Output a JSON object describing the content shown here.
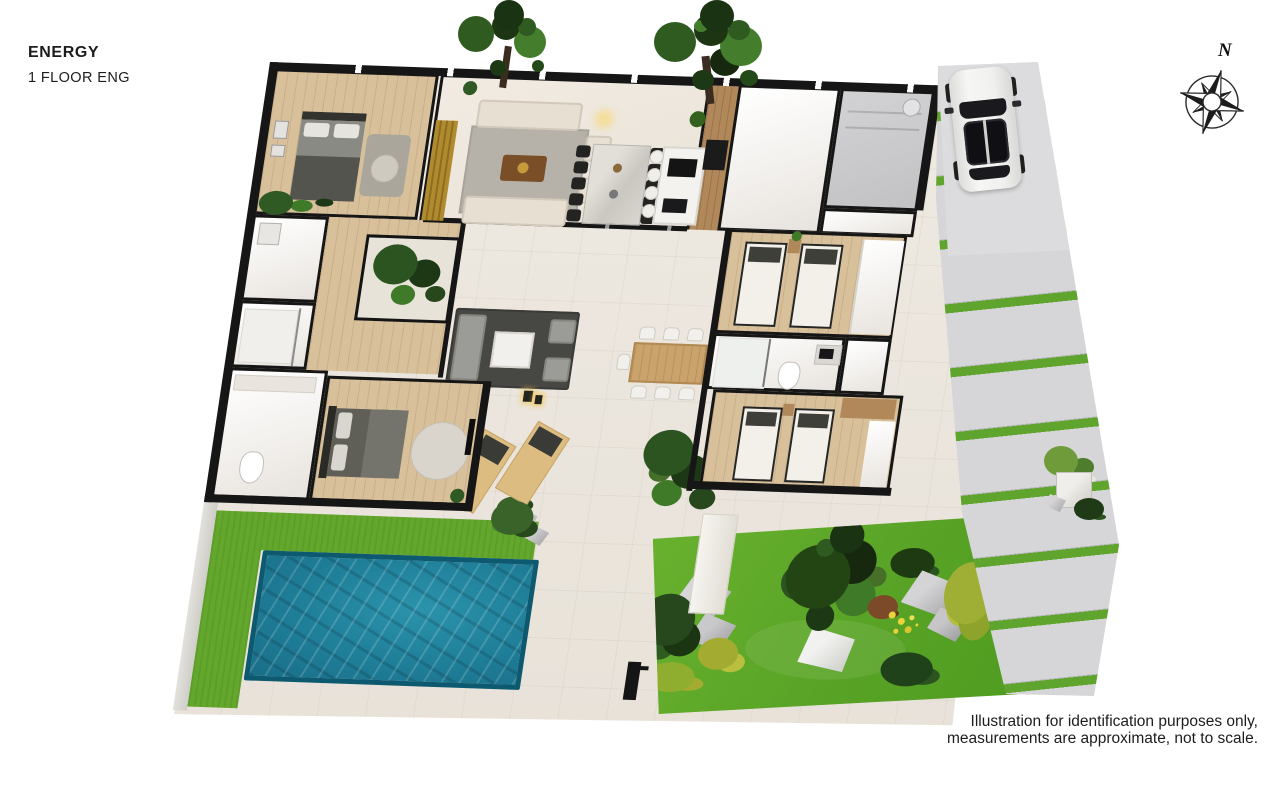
{
  "header": {
    "title": "ENERGY",
    "subtitle": "1 FLOOR ENG"
  },
  "compass": {
    "label": "N"
  },
  "disclaimer": {
    "line1": "Illustration for identification purposes only,",
    "line2": "measurements are approximate, not to scale."
  },
  "palette": {
    "background": "#ffffff",
    "wall": "#161616",
    "terrace": "#ece7df",
    "wood_floor": "#d8c09a",
    "wood_dark": "#b0885a",
    "white_floor": "#f7f5f2",
    "garage_floor": "#c9c9cb",
    "gold_wall": "#b08a2e",
    "rug_light": "#b6b2aa",
    "rug_dark": "#474744",
    "sofa_beige": "#e6dfd2",
    "sofa_gray": "#9b9b97",
    "bed_white": "#f3f0ea",
    "bed_gray": "#5f5f58",
    "frame_dark": "#262624",
    "pool_water": "#1f7e98",
    "pool_edge": "#0d5a70",
    "grass": "#63a82c",
    "paver": "#d6d6d8",
    "stripe_green": "#5fa42c",
    "driveway": "#dcdcde",
    "car_body": "#f0f0ee",
    "glass_dark": "#17171a",
    "rock": "#c6c6c8",
    "tree_dark": "#1d3513",
    "tree_mid": "#2f5a20",
    "tree_light": "#447e2c",
    "bush_yellow": "#a3ac31",
    "text": "#1c1c1c"
  }
}
